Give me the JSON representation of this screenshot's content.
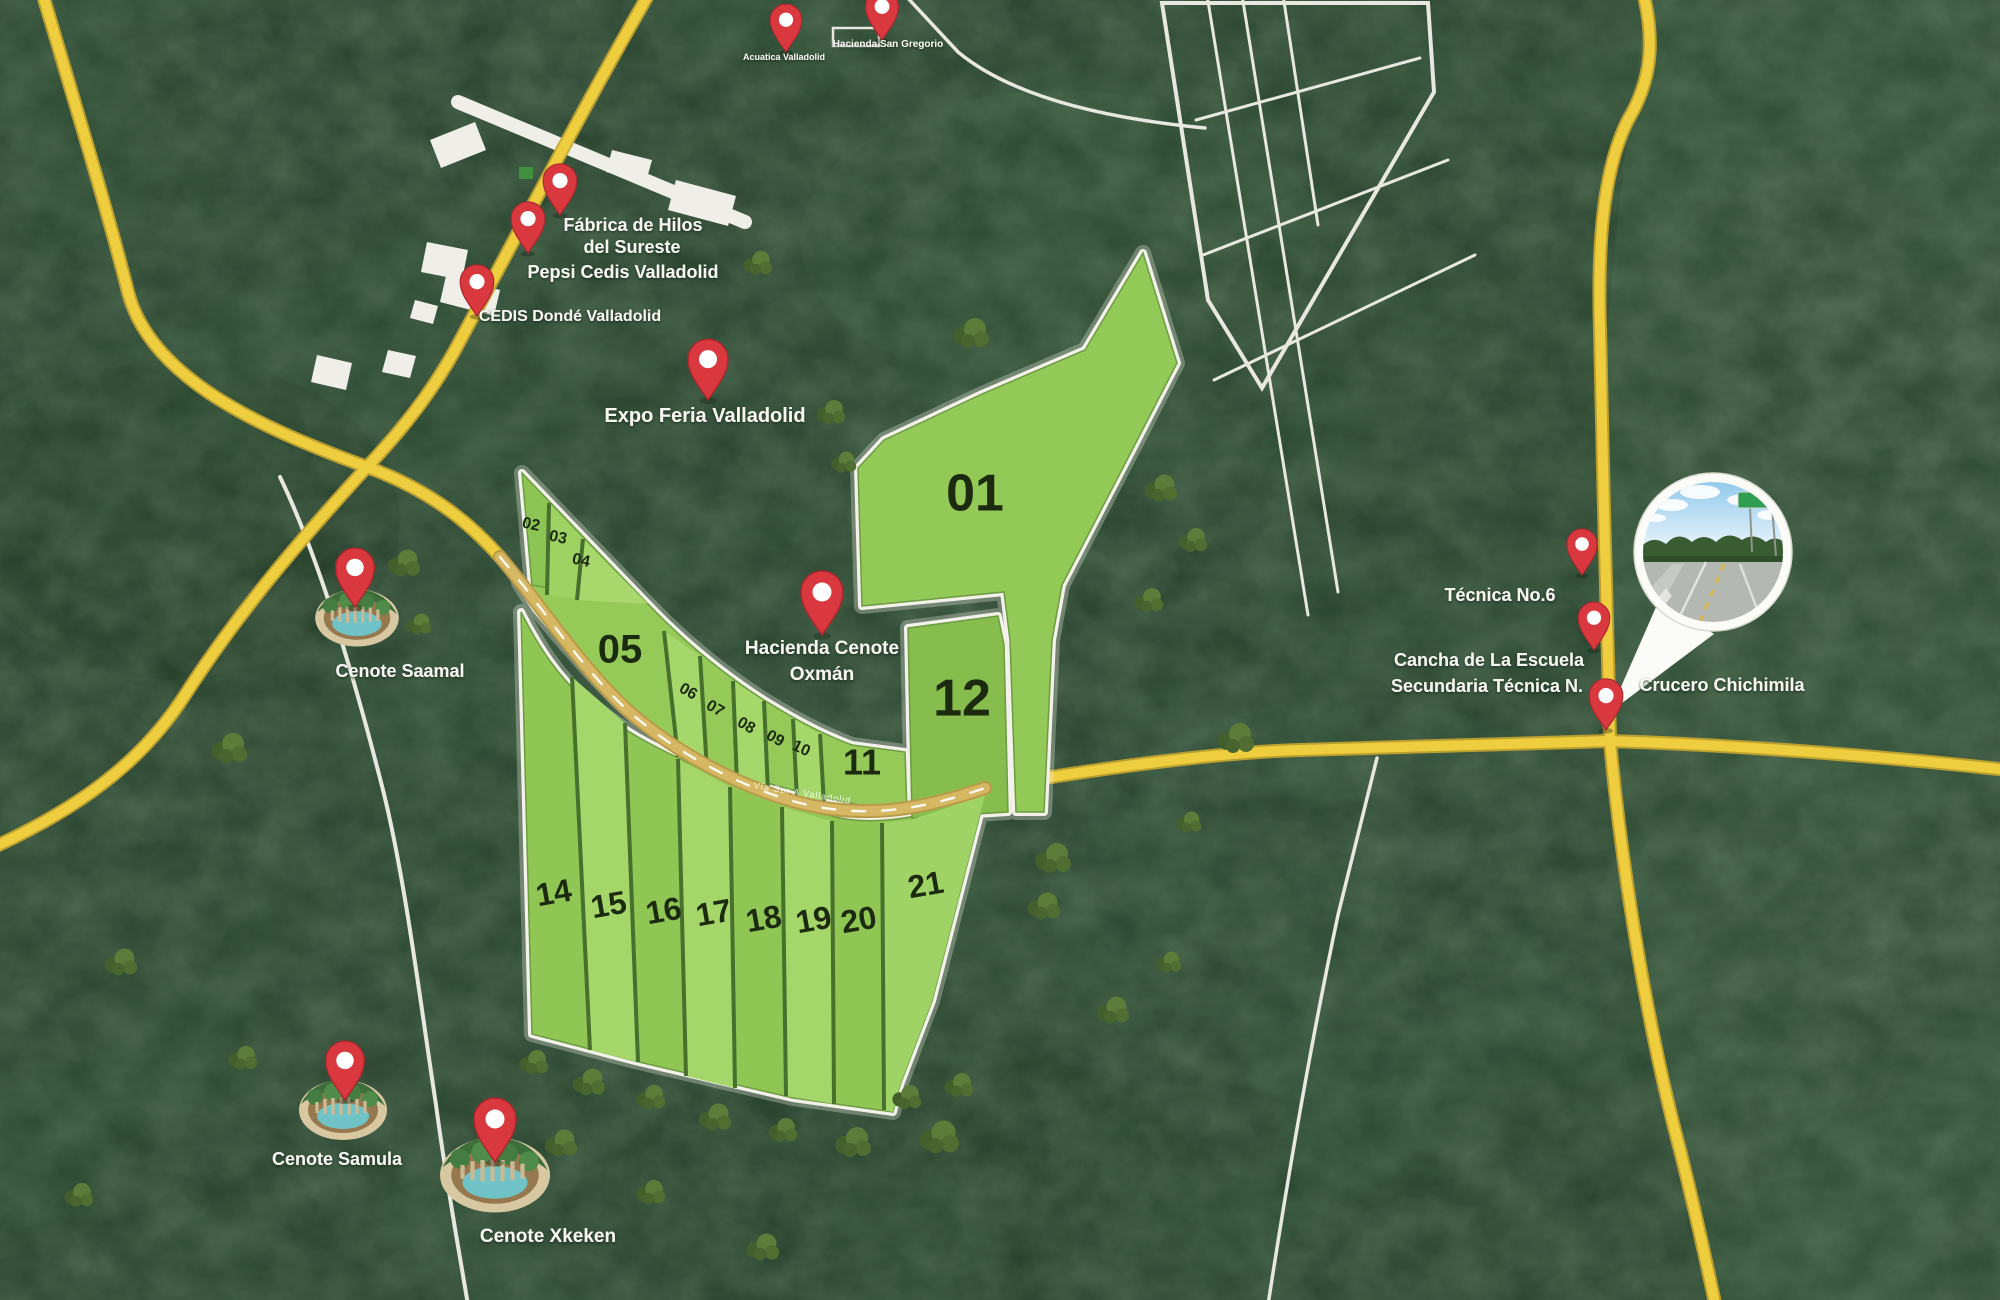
{
  "map": {
    "road_label": "Vía Sur A Valladolid",
    "lots": {
      "l01": "01",
      "l02": "02",
      "l03": "03",
      "l04": "04",
      "l05": "05",
      "l06": "06",
      "l07": "07",
      "l08": "08",
      "l09": "09",
      "l10": "10",
      "l11": "11",
      "l12": "12",
      "l14": "14",
      "l15": "15",
      "l16": "16",
      "l17": "17",
      "l18": "18",
      "l19": "19",
      "l20": "20",
      "l21": "21"
    },
    "pois": {
      "acuatica": "Acuatica Valladolid",
      "san_gregorio": "Hacienda San Gregorio",
      "fabrica_line1": "Fábrica de Hilos",
      "fabrica_line2": "del Sureste",
      "pepsi": "Pepsi Cedis Valladolid",
      "cedis": "CEDIS Dondé Valladolid",
      "expo": "Expo Feria Valladolid",
      "oxman_line1": "Hacienda Cenote",
      "oxman_line2": "Oxmán",
      "saamal": "Cenote Saamal",
      "samula": "Cenote Samula",
      "xkeken": "Cenote Xkeken",
      "tecnica": "Técnica No.6",
      "cancha_line1": "Cancha de La Escuela",
      "cancha_line2": "Secundaria Técnica N.",
      "crucero": "Crucero Chichimila"
    },
    "colors": {
      "forest": "#2b4531",
      "road_yellow": "#eecd3e",
      "road_dev": "#d6b763",
      "lot_green": "#93c957",
      "lot_green_light": "#a6d76c",
      "outline_white": "#f3f1e9",
      "pin_red": "#d9383e"
    }
  }
}
